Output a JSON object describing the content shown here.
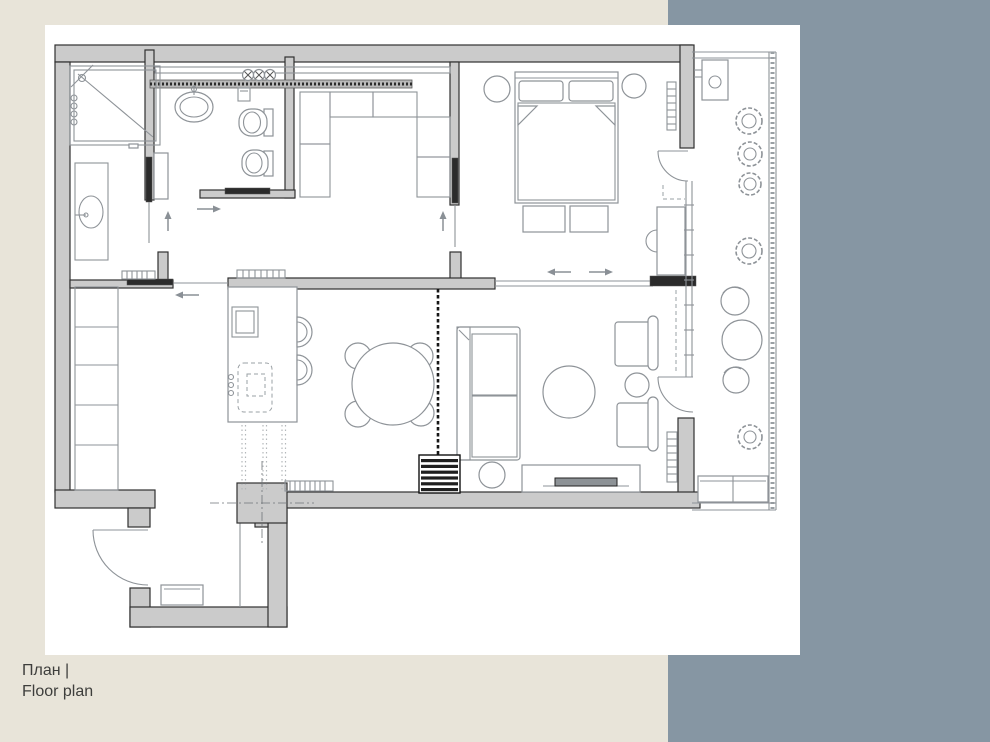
{
  "caption": {
    "line1": "План |",
    "line2": "Floor plan"
  },
  "colors": {
    "canvas_bg": "#e8e4d9",
    "panel_bg": "#8696a3",
    "sheet_bg": "#ffffff",
    "wall_fill": "#cbcbcb",
    "wall_stroke": "#303030",
    "furn": "#8e9398",
    "dark": "#1f1f1f",
    "dash": "#9aa0a4",
    "caption": "#3e3e3c"
  },
  "plan": {
    "type": "apartment-floor-plan",
    "rooms": [
      "bathroom",
      "wc",
      "dressing-room",
      "hallway",
      "bedroom",
      "kitchen-dining-living",
      "entrance-hall",
      "balcony"
    ],
    "furniture": [
      "shower",
      "towel-radiator",
      "vanity-sink",
      "wc-sink",
      "flush-plate",
      "toilet",
      "bidet",
      "ceiling-spotlights",
      "wardrobe-cells",
      "double-bed",
      "nightstand-stools",
      "bed-benches",
      "desk",
      "desk-chair",
      "radiators",
      "kitchen-island",
      "island-sink",
      "hood",
      "bar-stools",
      "dining-table",
      "dining-chairs",
      "curtain",
      "sofa",
      "coffee-table",
      "armchairs",
      "side-table",
      "floor-lamp",
      "tv-console",
      "tv",
      "media-unit",
      "structural-column",
      "doormat",
      "entry-door",
      "balcony-door-bedroom",
      "balcony-door-living",
      "plants",
      "balcony-chairs",
      "balcony-table",
      "balcony-bench",
      "balcony-unit"
    ]
  }
}
